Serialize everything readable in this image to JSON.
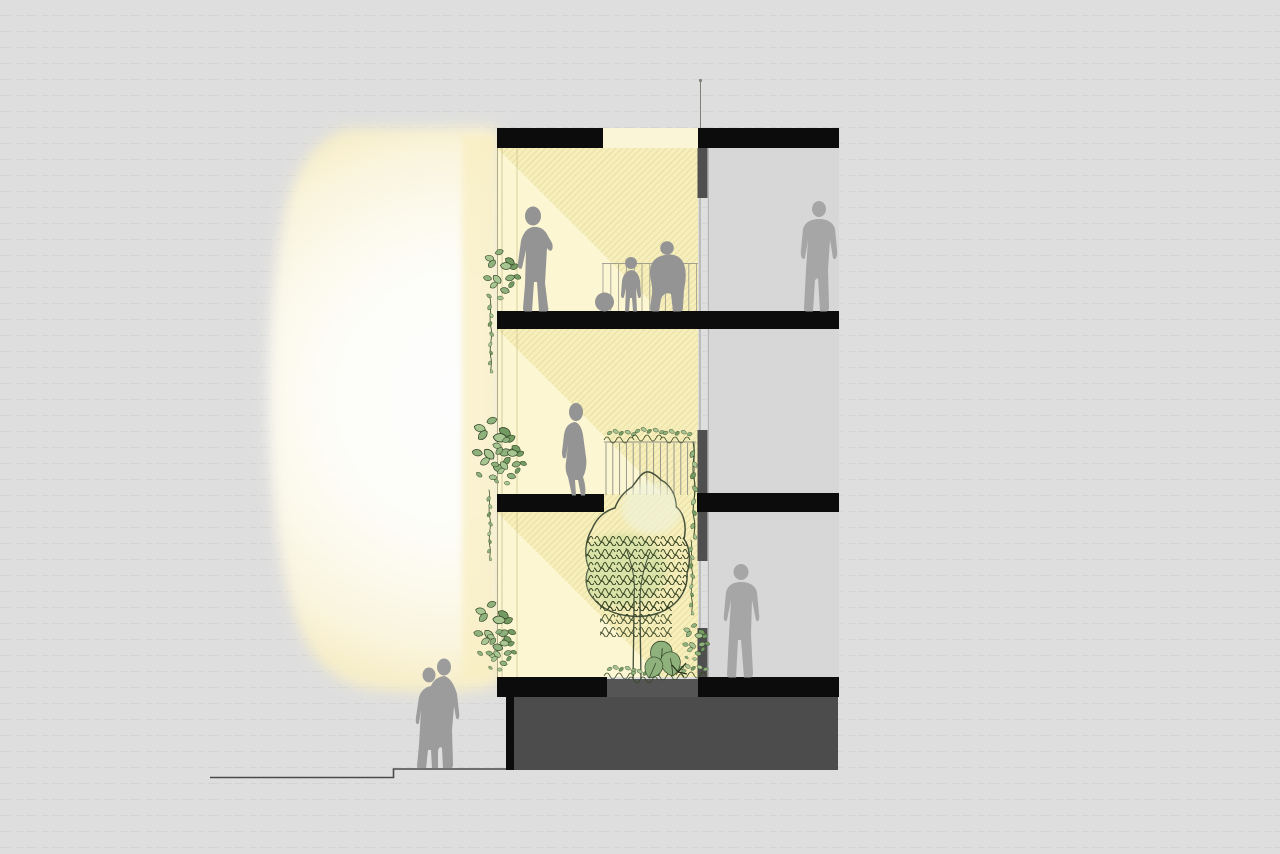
{
  "scene": {
    "type": "architectural-cross-section-illustration",
    "subject": "multi-storey building section with daylight atrium, hanging plants, interior tree and human silhouettes",
    "levels": [
      {
        "name": "roof-slab",
        "y": 128
      },
      {
        "name": "upper-floor-slab",
        "y": 311
      },
      {
        "name": "mid-floor-slab",
        "y": 494
      },
      {
        "name": "ground-plinth-top",
        "y": 677
      },
      {
        "name": "street-level",
        "y": 768
      }
    ],
    "figures": [
      {
        "id": "man-arms-folded",
        "location": "upper-floor-atrium"
      },
      {
        "id": "child-with-ball",
        "location": "upper-floor-atrium"
      },
      {
        "id": "crouching-adult",
        "location": "upper-floor-atrium"
      },
      {
        "id": "man-hands-in-pockets",
        "location": "upper-floor-right-zone"
      },
      {
        "id": "walking-woman",
        "location": "mid-floor-atrium"
      },
      {
        "id": "standing-man",
        "location": "ground-floor-right-zone"
      },
      {
        "id": "couple",
        "location": "street-level-outside"
      }
    ],
    "vegetation": [
      {
        "id": "hanging-plant-upper",
        "location": "atrium-left-facade"
      },
      {
        "id": "hanging-plant-middle",
        "location": "atrium-left-facade"
      },
      {
        "id": "hanging-plant-lower",
        "location": "atrium-left-facade"
      },
      {
        "id": "planted-balustrade",
        "location": "mid-floor-void-edge"
      },
      {
        "id": "hanging-vine-right",
        "location": "void-right-edge"
      },
      {
        "id": "atrium-tree",
        "location": "ground-floor-garden"
      },
      {
        "id": "ground-planting",
        "location": "ground-floor-planter"
      }
    ],
    "light": {
      "id": "daylight-glow",
      "appearance": "soft white-to-yellow glow entering atrium from the left with 45-degree hatched sun shafts inside"
    }
  },
  "colors": {
    "background": "#dedede",
    "right_zone": "#d7d7d7",
    "interior": "#f6eebb",
    "wedge": "#fcf6d2",
    "skylight": "#fbf5d8",
    "slab": "#0c0c0c",
    "plinth": "#4c4c4c",
    "planter": "#555555",
    "mullion": "#4f4f4f",
    "figure": "#949494",
    "figure_right": "#a6a6a6",
    "figure_couple": "#9c9c9c",
    "foliage": "#8fb27c",
    "foliage_light": "#a8c691",
    "foliage_deep": "#739a60",
    "foliage_dark": "#2f4226",
    "tree_fill": "#dfe9c4",
    "tree_wash": "#c9dd9f",
    "tree_high": "#eef3da",
    "tree_line": "#44503a",
    "ground_line": "#4a4a4a",
    "railing": "#8f8f85",
    "facade_line": "#b3ab80",
    "glass_line": "#9b9b93",
    "glow_core": "#ffffff",
    "glow_warm": "#f8efc8",
    "hatch_line": "#af9b37"
  }
}
